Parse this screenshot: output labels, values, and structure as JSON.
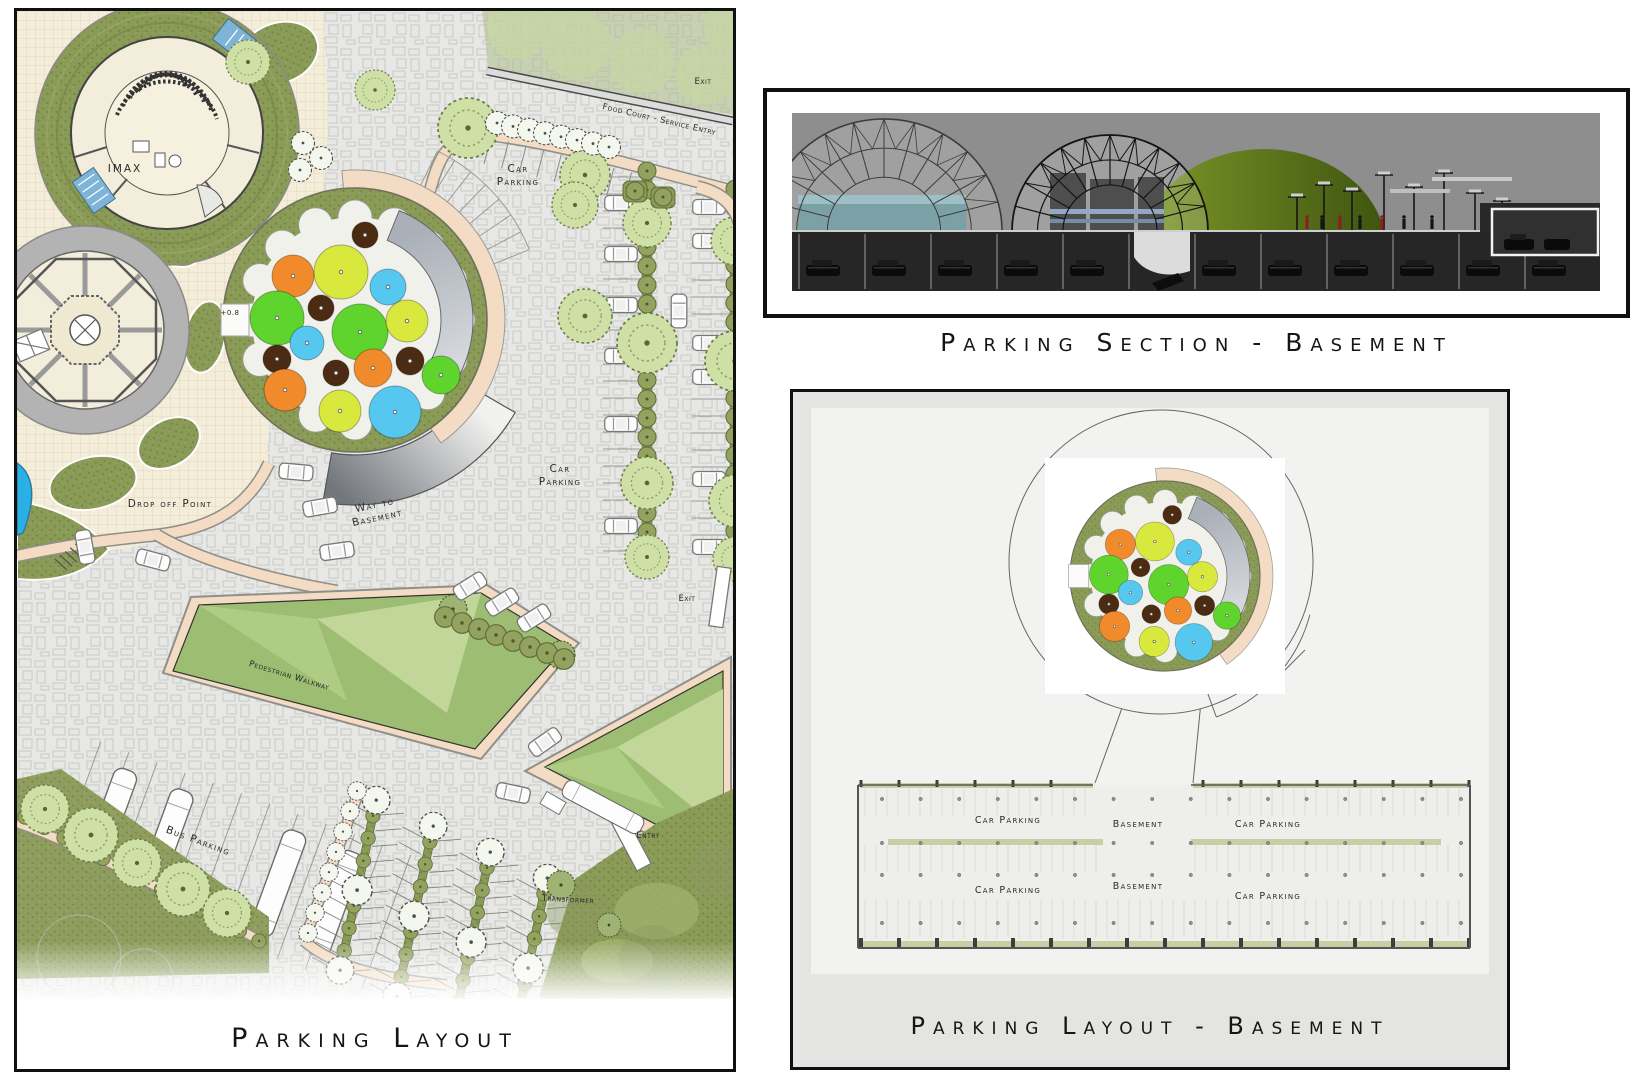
{
  "site_plan": {
    "title": "Parking Layout",
    "labels": {
      "imax": "IMAX",
      "car_parking_top": "Car Parking",
      "food_court_service_entry": "Food Court  -  Service Entry",
      "exit_top": "Exit",
      "drop_off_point": "Drop off Point",
      "way_to_basement": "Way to Basement",
      "car_parking_right": "Car Parking",
      "level_marker": "+0.8",
      "pedestrian_walkway": "Pedestrian Walkway",
      "bus_parking": "Bus Parking",
      "exit_right": "Exit",
      "entry": "Entry",
      "transformer": "Transformer"
    }
  },
  "section": {
    "title": "Parking Section - Basement"
  },
  "basement_plan": {
    "title": "Parking Layout - Basement",
    "row1": [
      "Car Parking",
      "Basement",
      "Car Parking"
    ],
    "row2": [
      "Car Parking",
      "Basement",
      "Car Parking"
    ]
  },
  "plaza": {
    "canopy_palette": {
      "orange": "#f18a2b",
      "chartreuse": "#d9e83d",
      "green": "#5ed42c",
      "blue": "#56c8f0",
      "brown": "#4b2c12"
    },
    "circles": [
      {
        "dx": 10,
        "dy": -85,
        "r": 13,
        "c": "brown"
      },
      {
        "dx": -14,
        "dy": -48,
        "r": 27,
        "c": "chartreuse"
      },
      {
        "dx": -62,
        "dy": -44,
        "r": 21,
        "c": "orange"
      },
      {
        "dx": 33,
        "dy": -33,
        "r": 18,
        "c": "blue"
      },
      {
        "dx": -34,
        "dy": -12,
        "r": 13,
        "c": "brown"
      },
      {
        "dx": -78,
        "dy": -2,
        "r": 27,
        "c": "green"
      },
      {
        "dx": 5,
        "dy": 12,
        "r": 28,
        "c": "green"
      },
      {
        "dx": 52,
        "dy": 1,
        "r": 21,
        "c": "chartreuse"
      },
      {
        "dx": -48,
        "dy": 23,
        "r": 17,
        "c": "blue"
      },
      {
        "dx": -78,
        "dy": 39,
        "r": 14,
        "c": "brown"
      },
      {
        "dx": -19,
        "dy": 53,
        "r": 13,
        "c": "brown"
      },
      {
        "dx": 18,
        "dy": 48,
        "r": 19,
        "c": "orange"
      },
      {
        "dx": 55,
        "dy": 41,
        "r": 14,
        "c": "brown"
      },
      {
        "dx": 86,
        "dy": 55,
        "r": 19,
        "c": "green"
      },
      {
        "dx": -70,
        "dy": 70,
        "r": 21,
        "c": "orange"
      },
      {
        "dx": -15,
        "dy": 91,
        "r": 21,
        "c": "chartreuse"
      },
      {
        "dx": 40,
        "dy": 92,
        "r": 26,
        "c": "blue"
      }
    ]
  },
  "colors": {
    "paving": "#e7e7e5",
    "paving_line": "#c2c2be",
    "cream": "#f3edd9",
    "cream_grid": "#ddd2b4",
    "lawn": "#8a9a57",
    "lawn_dark": "#6f7f41",
    "lawn_light": "#b9cf92",
    "lawn_mid": "#9cbd72",
    "lawn_pale": "#c2d69a",
    "path": "#f3dcc3",
    "path_edge": "#8f8f8b",
    "water": "#29b1e6",
    "plaza_ring": "#7e8f4d",
    "plaza_inner": "#f1f1ec",
    "band_gray": "#9aa1a9",
    "frame": "#101010",
    "ink": "#1d1d1d",
    "section_sky": "#8e8e8e",
    "section_dark": "#262626",
    "section_green": "#5e7a1e",
    "basement_bg": "#e4e4e2",
    "basement_inner": "#f2f2f0",
    "strip_olive": "#c9cfa4"
  }
}
